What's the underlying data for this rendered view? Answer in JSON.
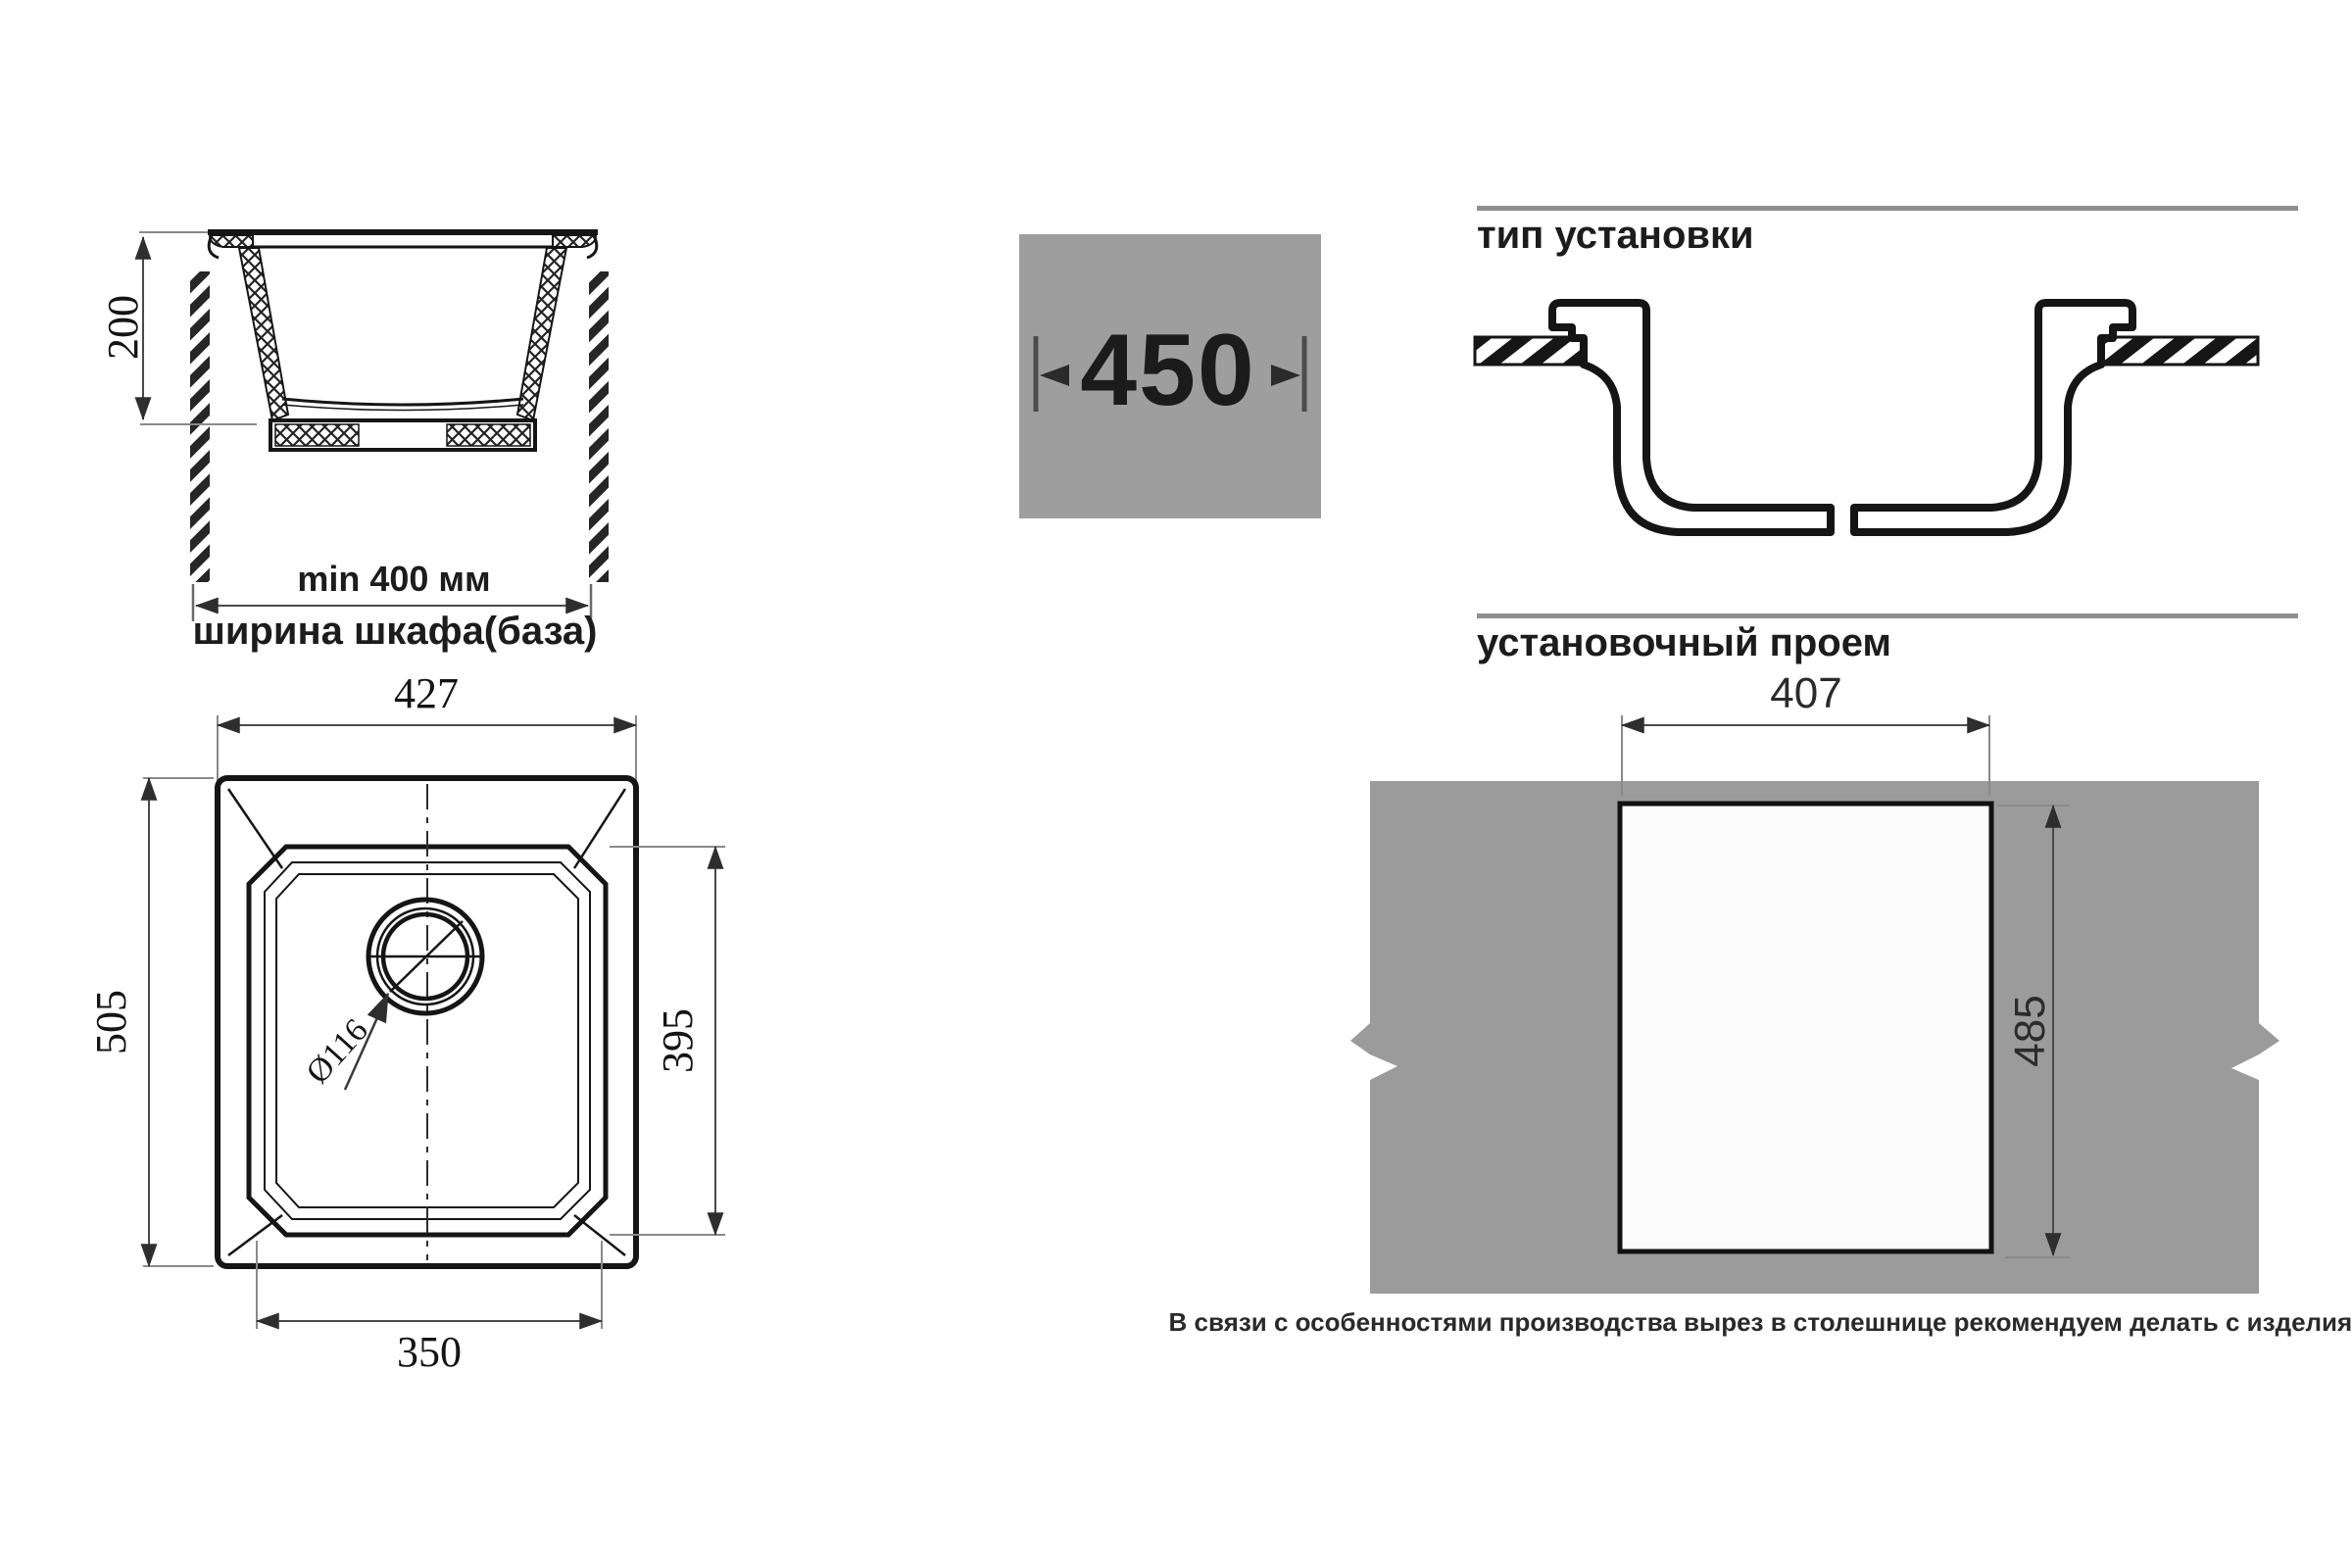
{
  "section_view": {
    "height_dim": "200",
    "min_width": "min 400 мм",
    "cabinet_width": "ширина шкафа(база)"
  },
  "badge": {
    "width": "450"
  },
  "install_type": {
    "heading": "тип установки"
  },
  "top_view": {
    "width_dim": "427",
    "height_dim": "505",
    "bowl_height_dim": "395",
    "bowl_width_dim": "350",
    "drain_dim": "Ø116"
  },
  "cutout_view": {
    "heading": "установочный проем",
    "width_dim": "407",
    "height_dim": "485",
    "note": "В связи с особенностями производства вырез в столешнице рекомендуем делать с изделия."
  },
  "colors": {
    "panel_gray": "#9b9b9b",
    "badge_gray": "#9e9e9e",
    "rule_gray": "#8f8f8f",
    "line_black": "#151515"
  }
}
